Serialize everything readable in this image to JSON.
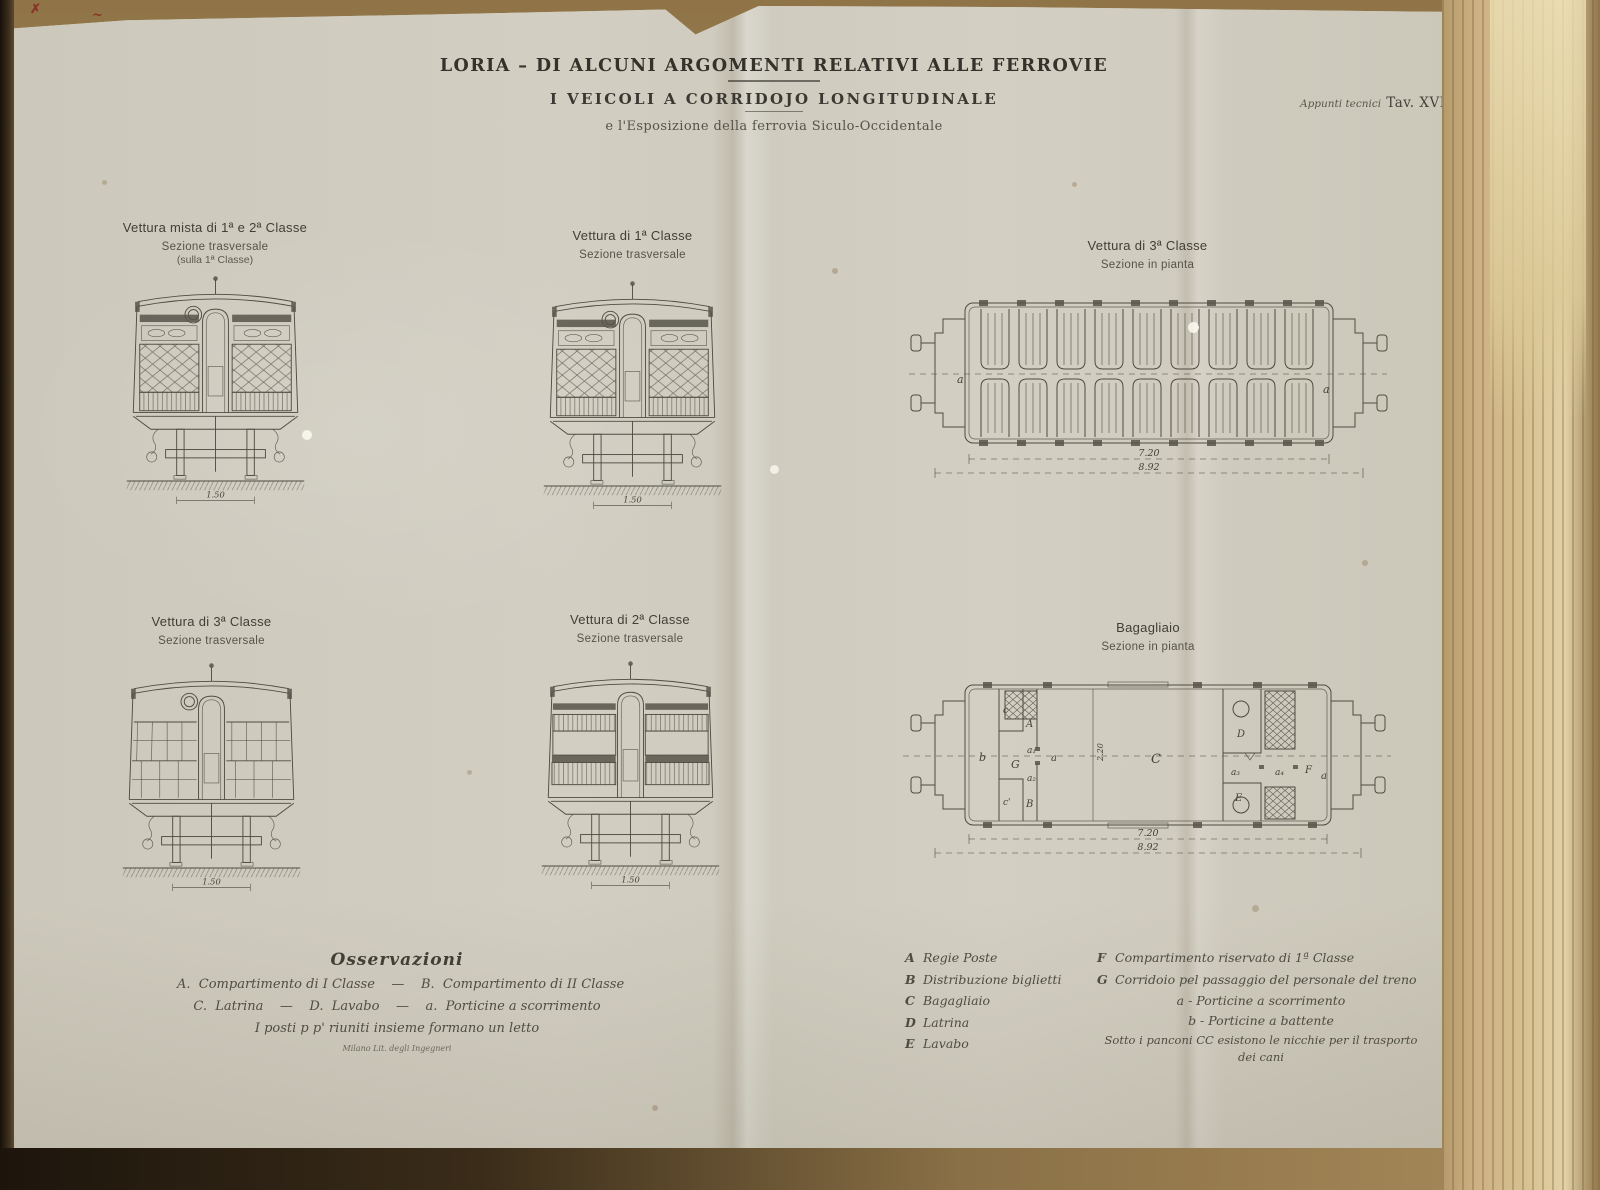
{
  "header": {
    "title_line1": "LORIA – DI ALCUNI ARGOMENTI RELATIVI ALLE FERROVIE",
    "title_line2": "I VEICOLI A CORRIDOJO LONGITUDINALE",
    "title_line3": "e l'Esposizione della ferrovia Siculo-Occidentale",
    "plate_note": "Appunti tecnici",
    "plate_number": "Tav. XVI"
  },
  "figures": {
    "mista": {
      "title": "Vettura mista di 1ª e 2ª Classe",
      "subtitle": "Sezione trasversale",
      "subtitle2": "(sulla 1ª Classe)",
      "scale": "1.50"
    },
    "prima": {
      "title": "Vettura di 1ª Classe",
      "subtitle": "Sezione trasversale",
      "scale": "1.50"
    },
    "terza_pianta": {
      "title": "Vettura di 3ª Classe",
      "subtitle": "Sezione in pianta",
      "dim_body": "7.20",
      "dim_total": "8.92",
      "corridor_label": "a"
    },
    "terza": {
      "title": "Vettura di 3ª Classe",
      "subtitle": "Sezione trasversale",
      "scale": "1.50"
    },
    "seconda": {
      "title": "Vettura di 2ª Classe",
      "subtitle": "Sezione trasversale",
      "scale": "1.50"
    },
    "bagagliaio": {
      "title": "Bagagliaio",
      "subtitle": "Sezione in pianta",
      "dim_body": "7.20",
      "dim_total": "8.92",
      "dim_width": "2.20",
      "labels": {
        "A": "A",
        "B": "B",
        "C": "C",
        "D": "D",
        "E": "E",
        "F": "F",
        "G": "G",
        "a": "a",
        "b": "b",
        "c": "c",
        "c2": "c'",
        "a1": "a₁",
        "a2": "a₂",
        "a3": "a₃",
        "a4": "a₄"
      }
    }
  },
  "osservazioni": {
    "title": "Osservazioni",
    "line1": "A.  Compartimento di I Classe    —    B.  Compartimento di II Classe",
    "line2": "C.  Latrina    —    D.  Lavabo    —    a.  Porticine a scorrimento",
    "line3": "I posti p p' riuniti insieme formano un letto",
    "credit": "Milano Lit. degli Ingegneri"
  },
  "legend": {
    "left": [
      {
        "letter": "A",
        "text": "Regie Poste"
      },
      {
        "letter": "B",
        "text": "Distribuzione biglietti"
      },
      {
        "letter": "C",
        "text": "Bagagliaio"
      },
      {
        "letter": "D",
        "text": "Latrina"
      },
      {
        "letter": "E",
        "text": "Lavabo"
      }
    ],
    "right": [
      {
        "letter": "F",
        "text": "Compartimento riservato di 1ª Classe"
      },
      {
        "letter": "G",
        "text": "Corridoio pel passaggio del personale del treno"
      }
    ],
    "door_a": "a - Porticine a scorrimento",
    "door_b": "b - Porticine a battente",
    "note_line1": "Sotto i panconi CC esistono le nicchie per il trasporto",
    "note_line2": "dei cani"
  }
}
